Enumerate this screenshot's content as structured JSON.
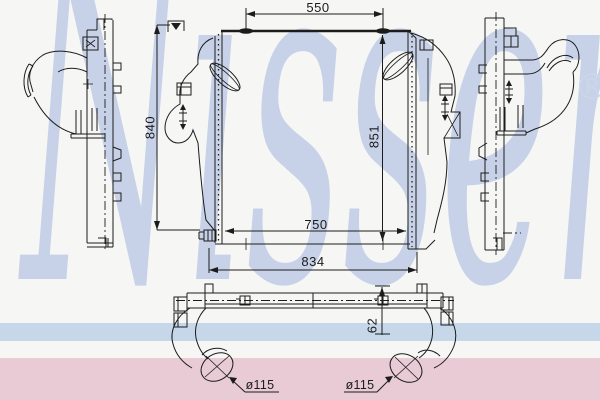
{
  "watermark": {
    "text": "Nissens",
    "registered": "®",
    "color": "#c7d2e8"
  },
  "footer_stripes": {
    "blue_color": "#c5d7e8",
    "pink_color": "#e8cbd4"
  },
  "drawing": {
    "line_color": "#1c1c1c",
    "dimensions": {
      "pipe_span_top": "550",
      "height_left": "840",
      "height_core": "851",
      "width_core": "750",
      "width_overall": "834",
      "depth": "62",
      "pipe_diameter_left": "ø115",
      "pipe_diameter_right": "ø115"
    }
  }
}
